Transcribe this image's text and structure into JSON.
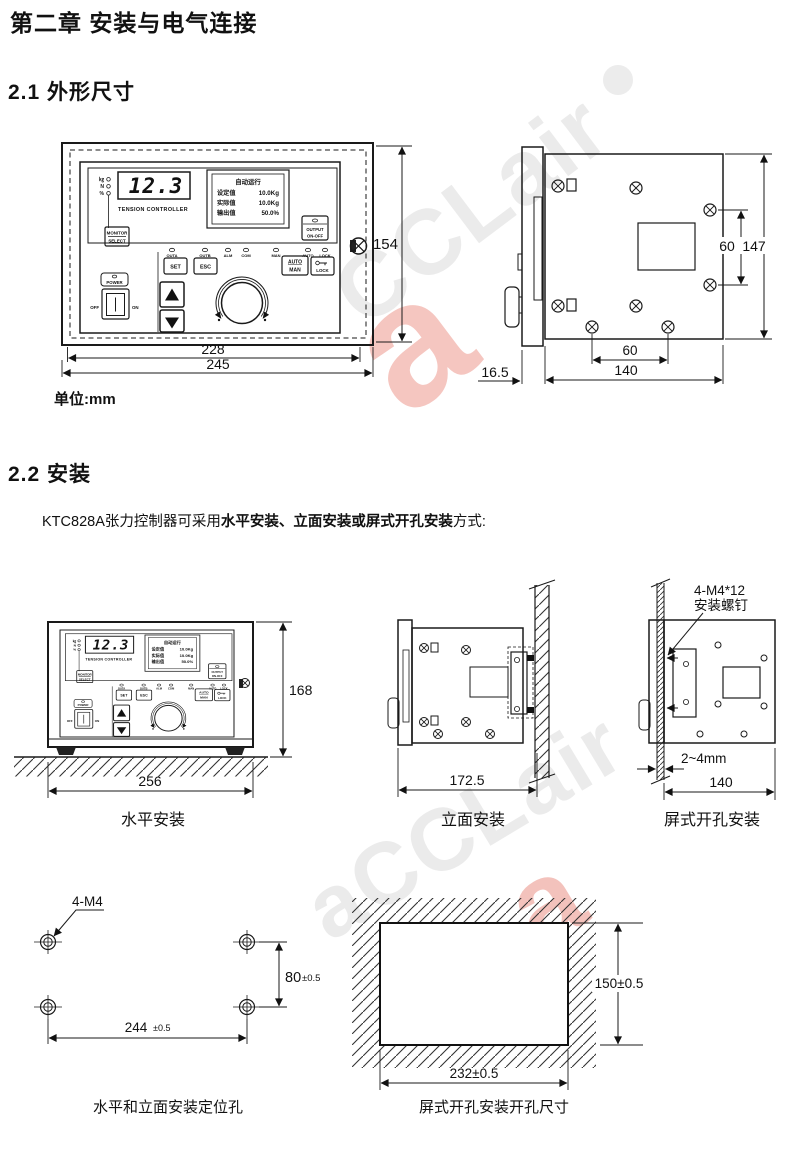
{
  "header": {
    "chapter": "第二章  安装与电气连接",
    "s1": "2.1 外形尺寸",
    "s2": "2.2 安装",
    "unit": "单位:mm",
    "intro_pre": "KTC828A张力控制器可采用",
    "intro_bold": "水平安装、立面安装或屏式开孔安装",
    "intro_post": "方式:"
  },
  "panel": {
    "lcd": "12.3",
    "brand": "TENSION CONTROLLER",
    "units": [
      "㎏",
      "N",
      "%"
    ],
    "monitor1": "MONITOR",
    "monitor2": "SELECT",
    "screen": {
      "title": "自动运行",
      "r1l": "设定值",
      "r1v": "10.0Kg",
      "r2l": "实际值",
      "r2v": "10.0Kg",
      "r3l": "输出值",
      "r3v": "50.0%"
    },
    "out1": "OUTPUT",
    "out2": "ON-OFF",
    "leds": [
      "OUTA",
      "OUTB",
      "ALM",
      "COM",
      "MAN",
      "AUTO",
      "LOCK"
    ],
    "set": "SET",
    "esc": "ESC",
    "auto": "AUTO",
    "man": "MAN",
    "lock": "LOCK",
    "power": "POWER",
    "off": "OFF",
    "on": "ON",
    "up_arrow": "▲",
    "down_arrow": "▼"
  },
  "dims": {
    "fv_h": "154",
    "fv_w1": "228",
    "fv_w2": "245",
    "sv_hole_v": "60",
    "sv_h": "147",
    "sv_hole_h": "60",
    "sv_d": "140",
    "sv_bezel": "16.5",
    "ha_h": "168",
    "ha_w": "256",
    "va_w": "172.5",
    "pm_screw1": "4-M4*12",
    "pm_screw2": "安装螺钉",
    "pm_t": "2~4mm",
    "pm_w": "140",
    "holes_callout": "4-M4",
    "holes_v": "80",
    "holes_v_tol": "±0.5",
    "holes_h": "244",
    "holes_h_tol": "±0.5",
    "cut_v": "150±0.5",
    "cut_h": "232±0.5"
  },
  "captions": {
    "horizontal": "水平安装",
    "vertical": "立面安装",
    "panel_mount": "屏式开孔安装",
    "holes": "水平和立面安装定位孔",
    "cutout": "屏式开孔安装开孔尺寸"
  },
  "watermark": {
    "t1": "CCLair",
    "t2": "aCCLair",
    "logo_glyph": "a",
    "text_color": "#ebebeb",
    "logo_color": "#f5c6c0",
    "dot_color": "#ececec"
  }
}
